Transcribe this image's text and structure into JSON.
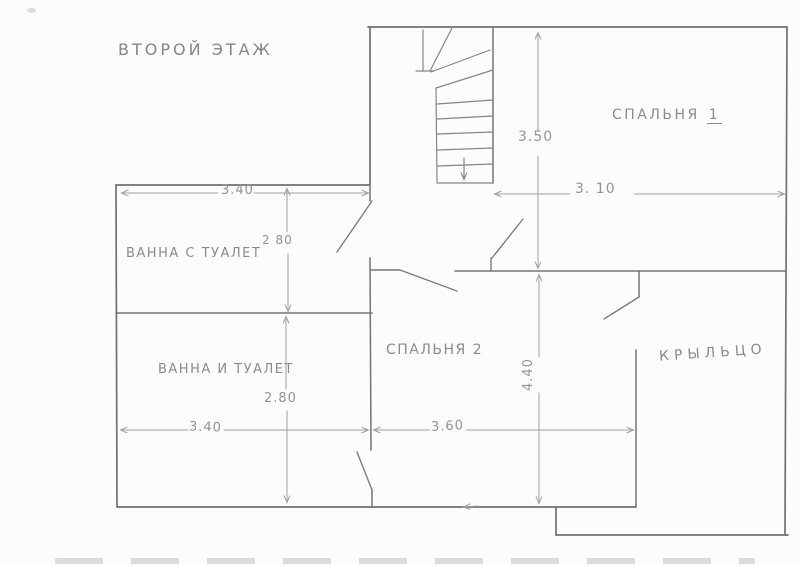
{
  "page": {
    "title": "ВТОРОЙ ЭТАЖ"
  },
  "rooms": {
    "bedroom1": {
      "label": "СПАЛЬНЯ",
      "number": "1"
    },
    "bedroom2": {
      "label": "СПАЛЬНЯ 2"
    },
    "bath_top": {
      "label": "ВАННА С ТУАЛЕТ"
    },
    "bath_bottom": {
      "label": "ВАННА И ТУАЛЕТ"
    },
    "porch": {
      "label": "КРЫЛЬЦО"
    }
  },
  "dimensions": {
    "bath_top_width": "3.40",
    "bath_top_depth": "2 80",
    "bedroom1_depth": "3.50",
    "bedroom1_width": "3. 10",
    "bath_bottom_depth": "2.80",
    "bath_bottom_width": "3.40",
    "bedroom2_width": "3.60",
    "bedroom2_depth": "4.40"
  },
  "colors": {
    "paper": "#fcfcfa",
    "wall_stroke": "#707070",
    "door_stroke": "#7d7d7d",
    "dimension_stroke": "#a0a0a0",
    "pencil_text": "#878c90"
  }
}
